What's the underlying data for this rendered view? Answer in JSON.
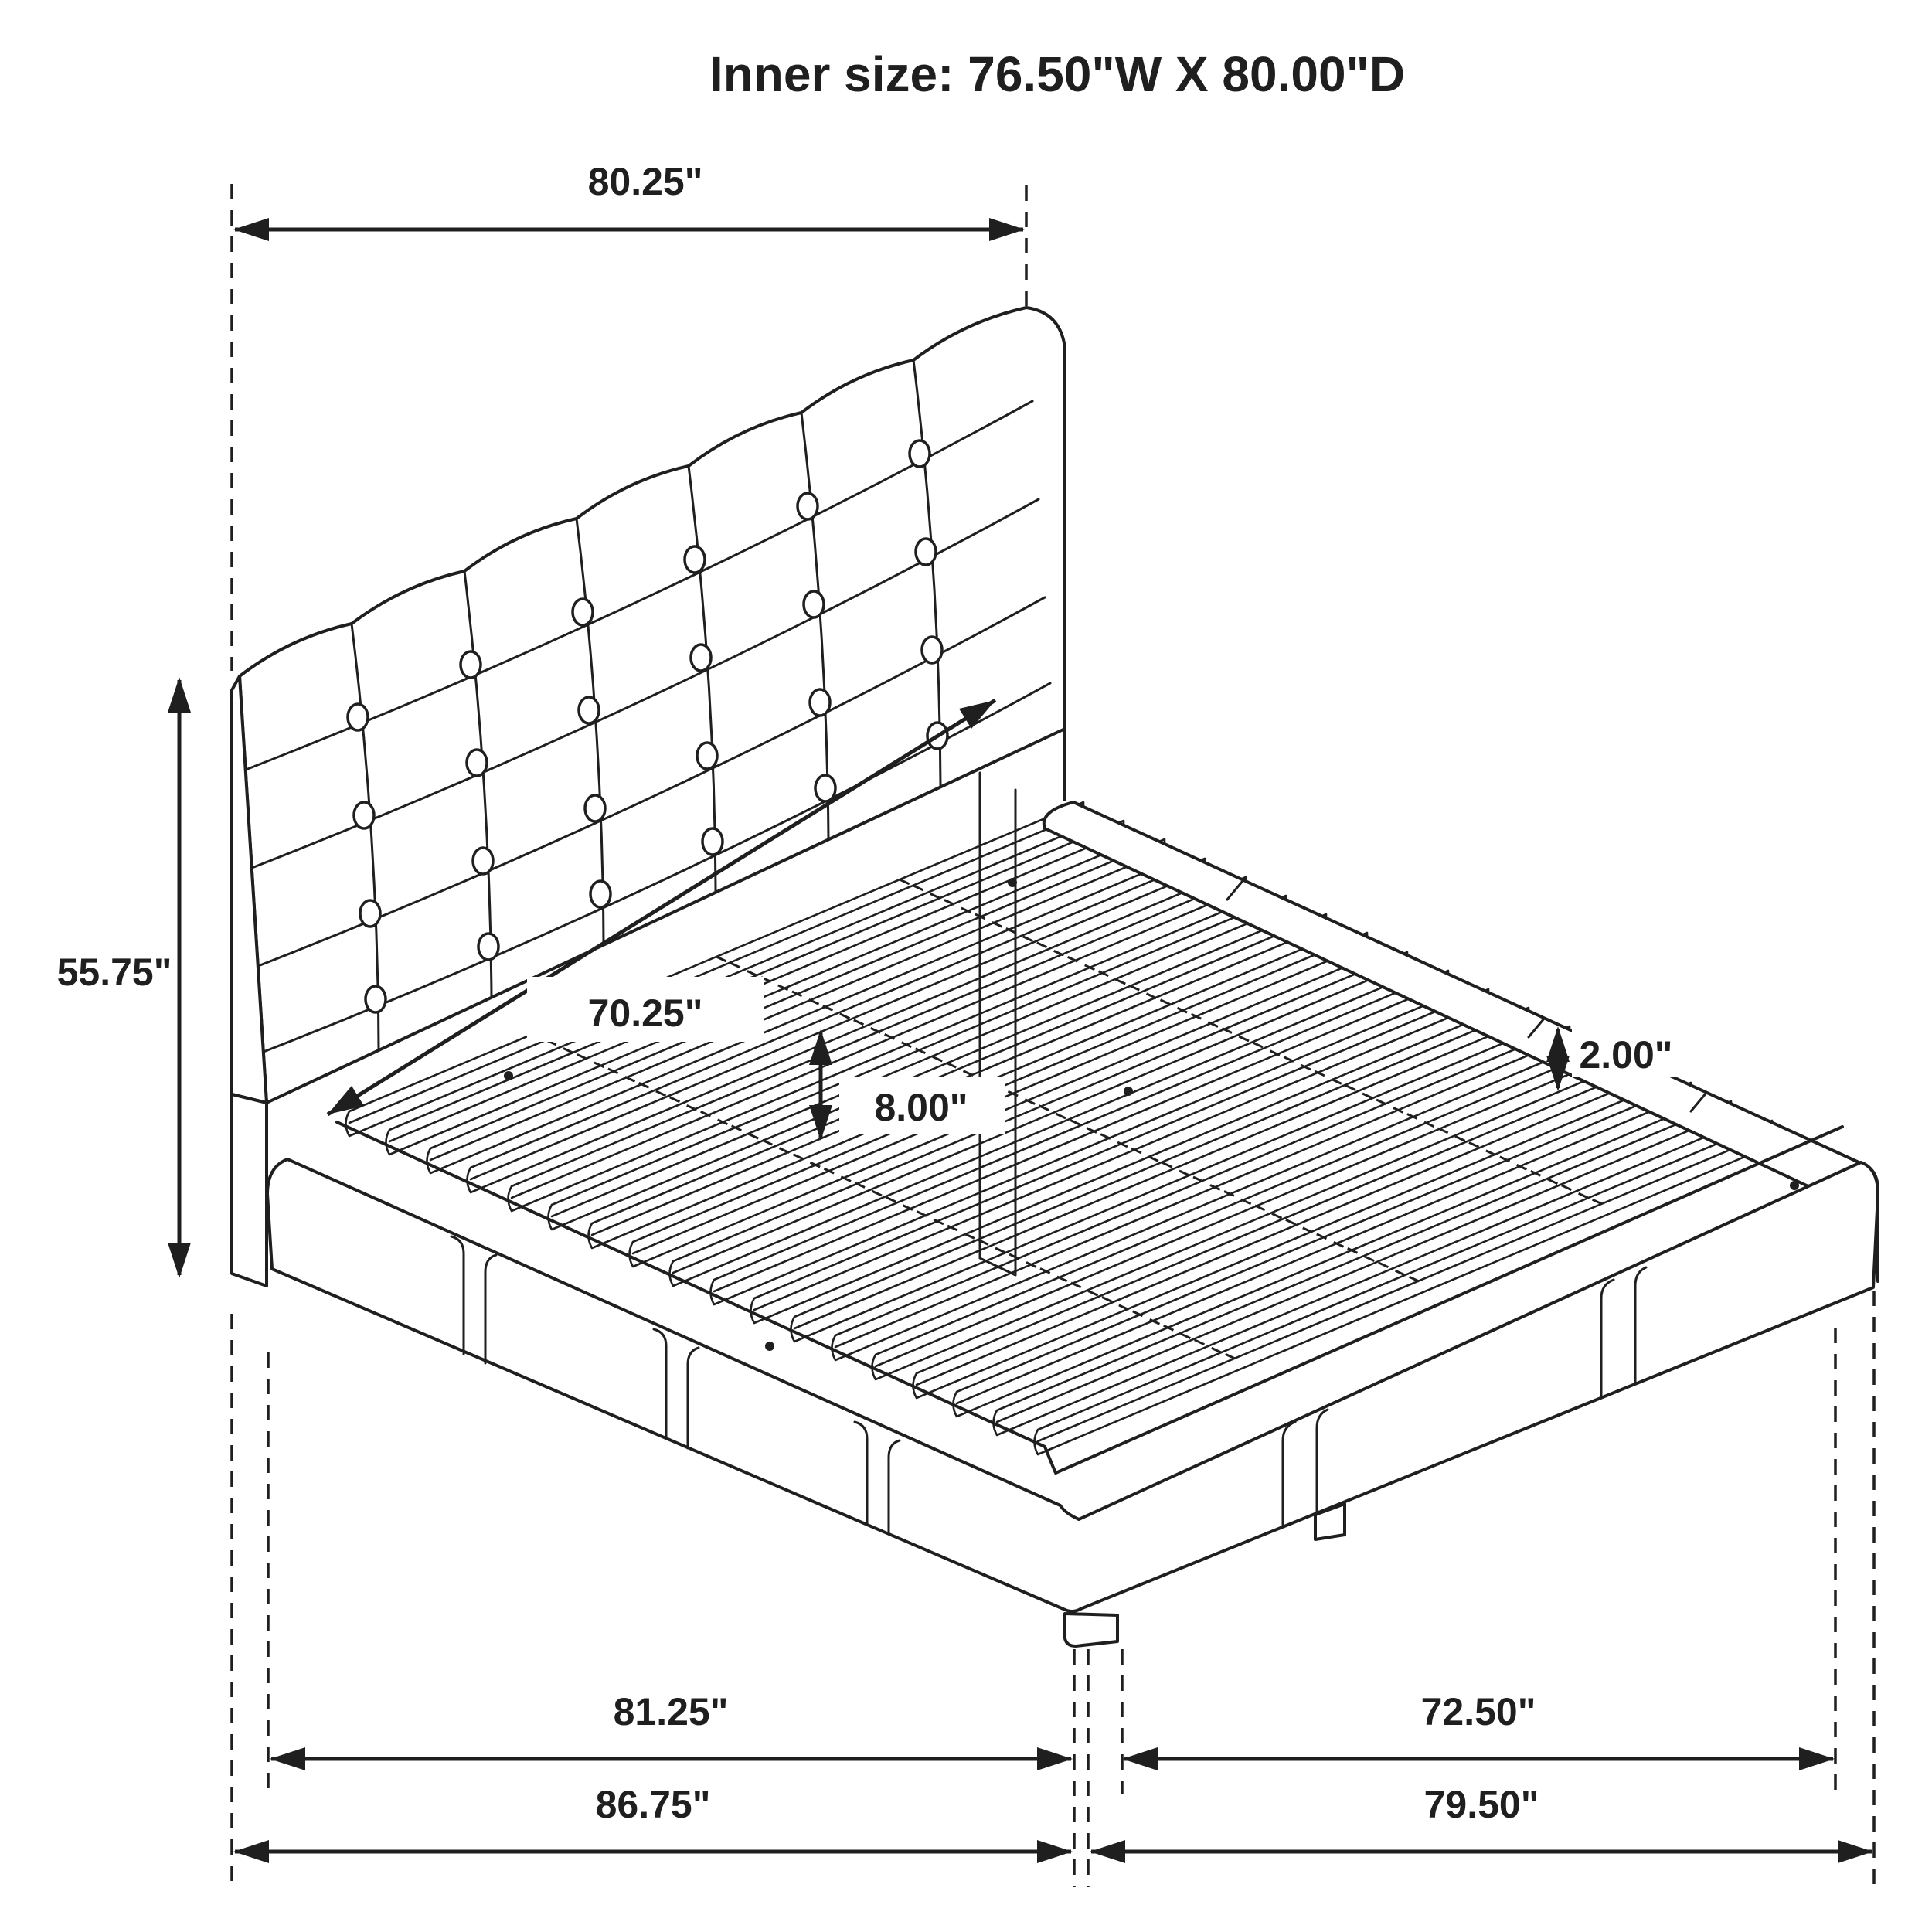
{
  "title": "Inner size: 76.50\"W X 80.00\"D",
  "colors": {
    "ink": "#1f1f1f",
    "background": "#ffffff"
  },
  "labels": {
    "headboard_width": "80.25\"",
    "headboard_height": "55.75\"",
    "slat_area_width": "70.25\"",
    "platform_height": "8.00\"",
    "slat_thickness": "2.00\"",
    "base_length_inner": "81.25\"",
    "base_depth_inner": "72.50\"",
    "overall_length": "86.75\"",
    "overall_depth": "79.50\""
  }
}
